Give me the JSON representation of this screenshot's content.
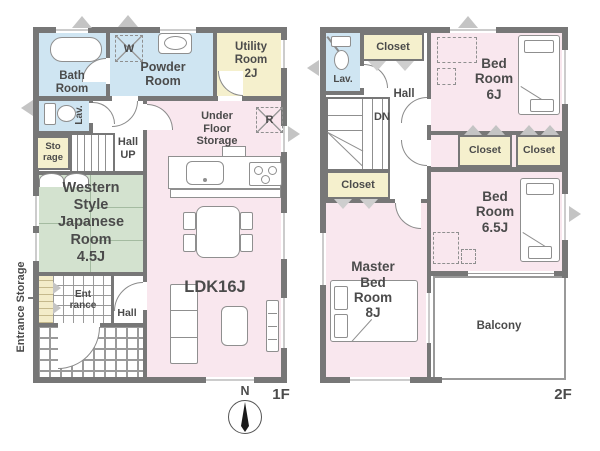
{
  "colors": {
    "wall": "#777777",
    "room_blue": "#cfe5f2",
    "room_yellow": "#f5f0cd",
    "room_pink": "#f9e7ee",
    "room_green": "#d3e2cf",
    "tile_yellow": "#f3ecc9",
    "text": "#4b4b4b"
  },
  "f1": {
    "floor_label": "1F",
    "compass_north": "N",
    "rooms": {
      "bath": "Bath\nRoom",
      "powder": "Powder\nRoom",
      "utility": "Utility\nRoom\n2J",
      "lav": "Lav.",
      "storage": "Sto\nrage",
      "hall_up": "Hall\nUP",
      "under_floor": "Under\nFloor\nStorage",
      "japanese": "Western\nStyle\nJapanese\nRoom\n4.5J",
      "ldk": "LDK16J",
      "entrance": "Ent\nrance",
      "hall": "Hall",
      "entrance_storage": "Entrance Storage"
    },
    "icons": {
      "washer": "W",
      "fridge": "R"
    }
  },
  "f2": {
    "floor_label": "2F",
    "rooms": {
      "lav": "Lav.",
      "closet_hall": "Closet",
      "hall": "Hall",
      "dn": "DN",
      "bed6": "Bed\nRoom\n6J",
      "closet_a": "Closet",
      "closet_b": "Closet",
      "bed65": "Bed\nRoom\n6.5J",
      "closet_master": "Closet",
      "master": "Master\nBed\nRoom\n8J",
      "balcony": "Balcony"
    }
  }
}
